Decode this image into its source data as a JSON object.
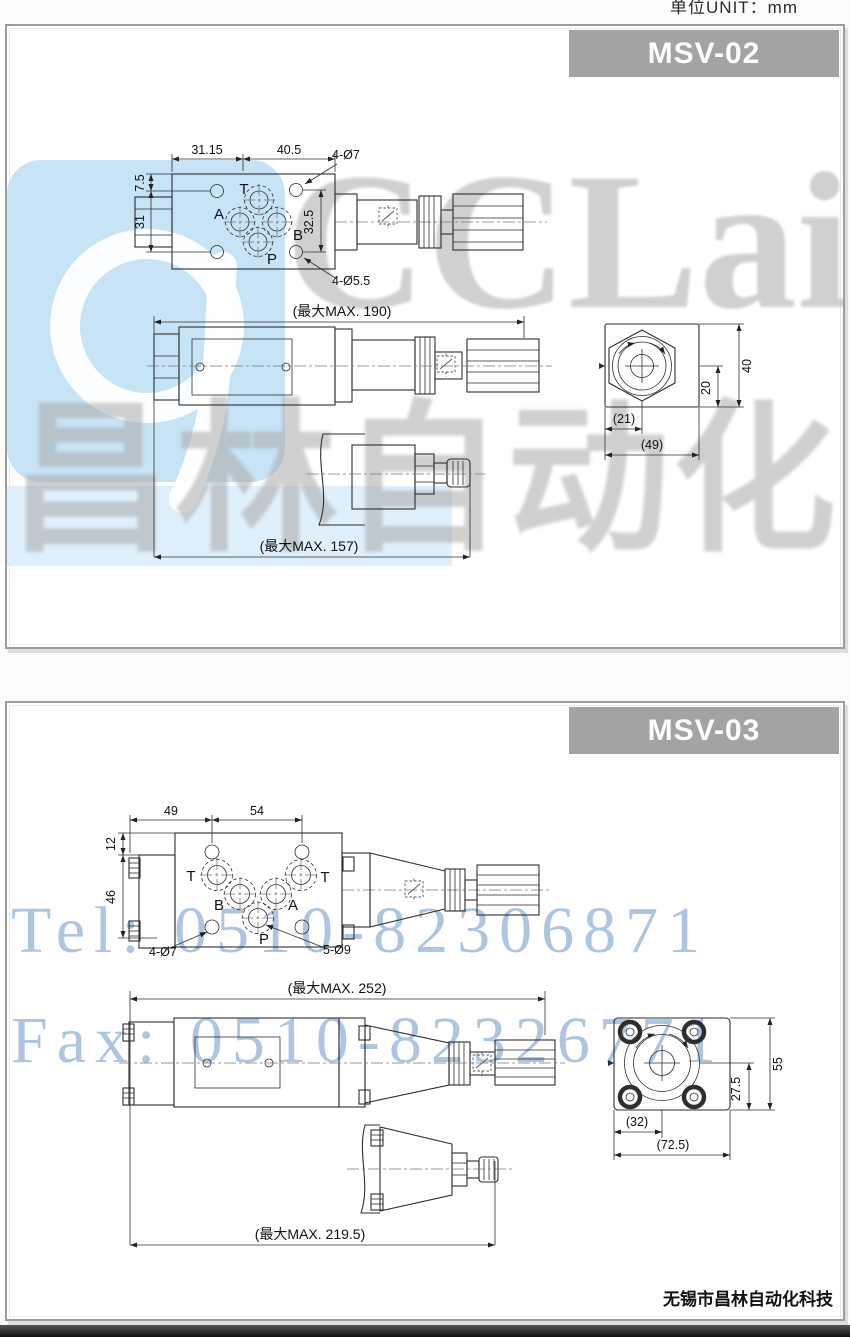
{
  "page": {
    "unit_label": "单位UNIT：mm",
    "footer": "无锡市昌林自动化科技"
  },
  "colors": {
    "header_bg": "#a3a3a3",
    "header_text": "#ffffff",
    "line": "#2e2e2e",
    "watermark_gray": "#a9a9a9",
    "watermark_blue": "#9bb7dc",
    "logo_blue": "#c7e3f6",
    "bottom_bar": "#1a1a1a"
  },
  "wm": {
    "brand": "CCLair",
    "brand_cn": "昌林自动化",
    "tel": "Tel: 0510-82306871",
    "fax": "Fax: 0510-82326771"
  },
  "p1": {
    "model": "MSV-02",
    "dim_31_15": "31.15",
    "dim_40_5": "40.5",
    "holes_top": "4-Ø7",
    "dim_7_5": "7.5",
    "dim_31": "31",
    "dim_32_5": "32.5",
    "holes_bottom": "4-Ø5.5",
    "max_190": "(最大MAX. 190)",
    "dim_21": "(21)",
    "dim_49": "(49)",
    "dim_20": "20",
    "dim_40": "40",
    "max_157": "(最大MAX. 157)",
    "ports": {
      "t": "T",
      "a": "A",
      "b": "B",
      "p": "P"
    }
  },
  "p2": {
    "model": "MSV-03",
    "dim_49": "49",
    "dim_54": "54",
    "dim_12": "12",
    "dim_46": "46",
    "holes_small": "4-Ø7",
    "holes_large": "5-Ø9",
    "max_252": "(最大MAX. 252)",
    "dim_32": "(32)",
    "dim_72_5": "(72.5)",
    "dim_27_5": "27.5",
    "dim_55": "55",
    "max_219": "(最大MAX. 219.5)",
    "ports": {
      "t1": "T",
      "b": "B",
      "a": "A",
      "t2": "T",
      "p": "P"
    }
  }
}
